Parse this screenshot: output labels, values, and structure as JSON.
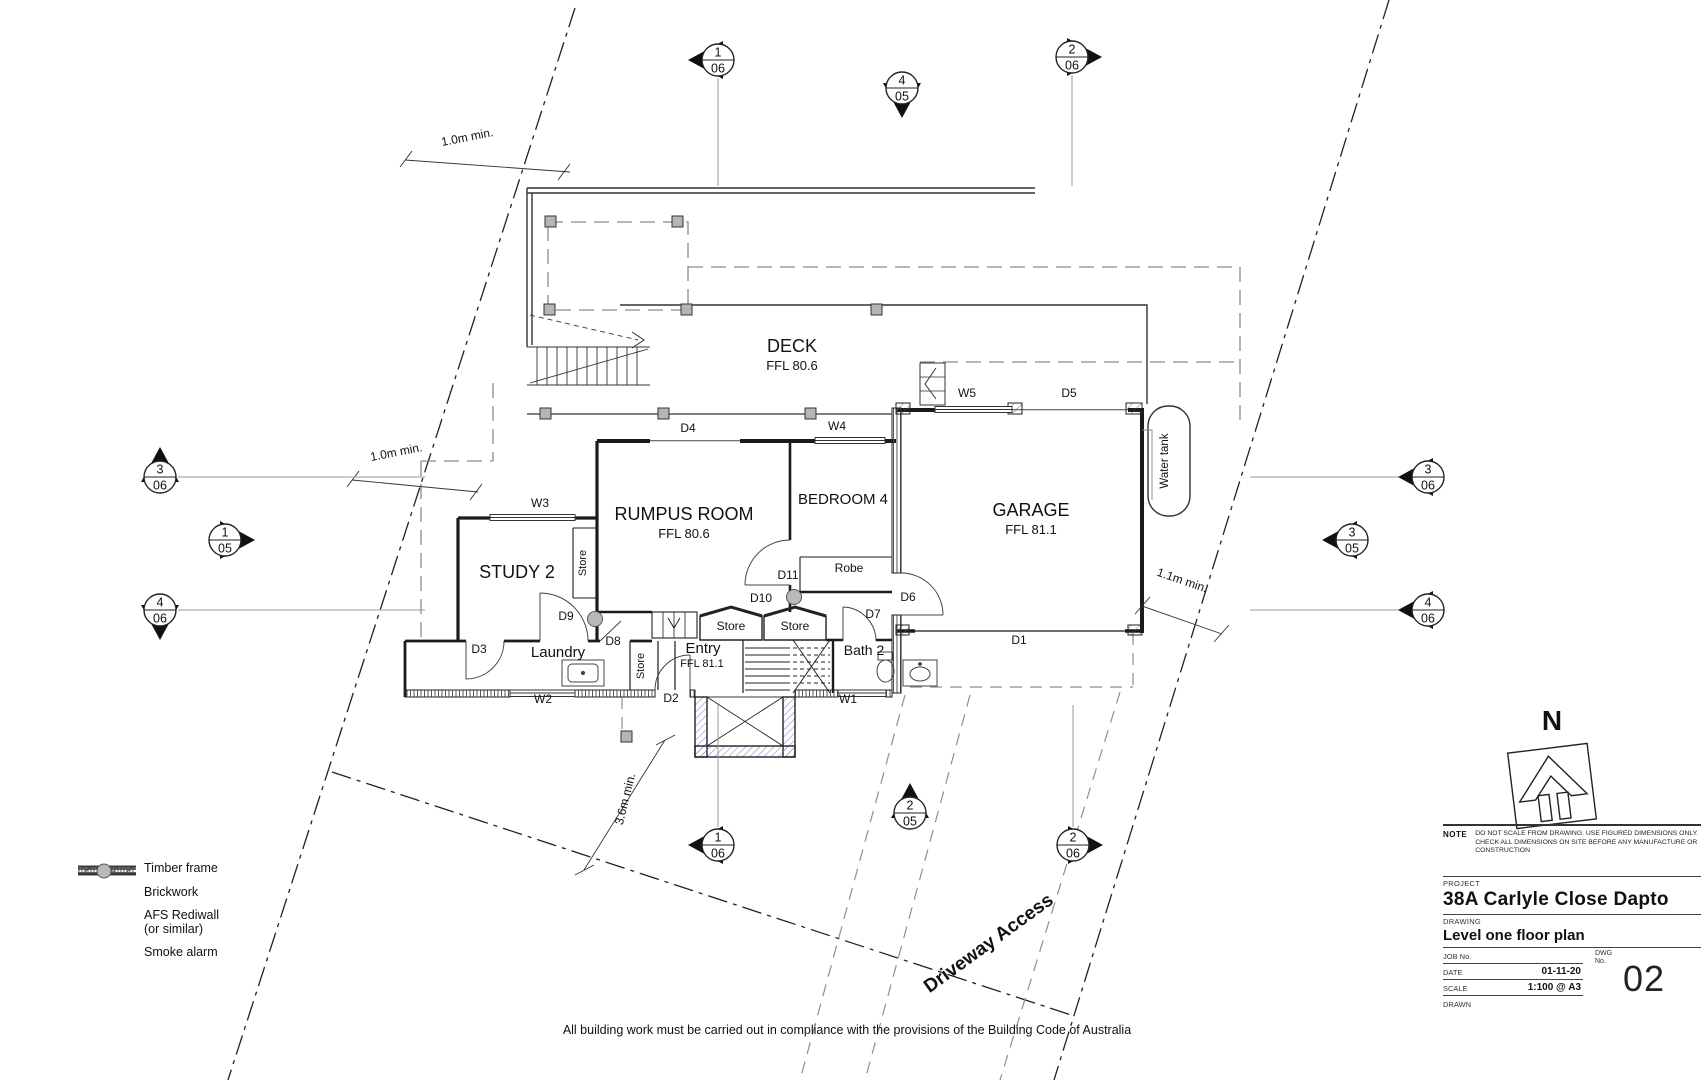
{
  "sheet": {
    "footer": "All building work must be carried out in compliance with the provisions of the Building Code of Australia"
  },
  "plan": {
    "rooms": [
      {
        "name": "DECK",
        "ffl": "FFL 80.6"
      },
      {
        "name": "RUMPUS ROOM",
        "ffl": "FFL 80.6"
      },
      {
        "name": "STUDY 2"
      },
      {
        "name": "BEDROOM 4"
      },
      {
        "name": "GARAGE",
        "ffl": "FFL 81.1"
      },
      {
        "name": "Laundry"
      },
      {
        "name": "Entry",
        "ffl": "FFL 81.1"
      },
      {
        "name": "Bath 2"
      },
      {
        "name": "Robe"
      }
    ],
    "stores": [
      "Store",
      "Store",
      "Store",
      "Store"
    ],
    "doors": [
      "D1",
      "D2",
      "D3",
      "D4",
      "D5",
      "D6",
      "D7",
      "D8",
      "D9",
      "D10",
      "D11"
    ],
    "windows": [
      "W1",
      "W2",
      "W3",
      "W4",
      "W5"
    ],
    "dimensions": [
      "1.0m min.",
      "1.0m min.",
      "1.1m min.",
      "3.6m min."
    ],
    "annotations": {
      "water_tank": "Water tank",
      "driveway": "Driveway Access",
      "north": "N"
    }
  },
  "markers": [
    {
      "num": "1",
      "sheet": "06"
    },
    {
      "num": "4",
      "sheet": "05"
    },
    {
      "num": "2",
      "sheet": "06"
    },
    {
      "num": "3",
      "sheet": "06"
    },
    {
      "num": "1",
      "sheet": "05"
    },
    {
      "num": "4",
      "sheet": "06"
    },
    {
      "num": "3",
      "sheet": "06"
    },
    {
      "num": "3",
      "sheet": "05"
    },
    {
      "num": "4",
      "sheet": "06"
    },
    {
      "num": "1",
      "sheet": "06"
    },
    {
      "num": "2",
      "sheet": "05"
    },
    {
      "num": "2",
      "sheet": "06"
    }
  ],
  "legend": {
    "items": [
      {
        "label": "Timber frame",
        "symbol": "timber-frame"
      },
      {
        "label": "Brickwork",
        "symbol": "brickwork"
      },
      {
        "label": "AFS Rediwall",
        "label2": "(or similar)",
        "symbol": "afs-rediwall"
      },
      {
        "label": "Smoke alarm",
        "symbol": "smoke-alarm"
      }
    ]
  },
  "title_block": {
    "note_label": "NOTE",
    "note_line1": "DO NOT SCALE FROM DRAWING.  USE FIGURED DIMENSIONS ONLY.",
    "note_line2": "CHECK ALL DIMENSIONS ON SITE BEFORE ANY MANUFACTURE OR CONSTRUCTION",
    "project_label": "PROJECT",
    "project": "38A Carlyle Close Dapto",
    "drawing_label": "DRAWING",
    "drawing": "Level one floor plan",
    "job_label": "JOB No.",
    "dwg_label_1": "DWG",
    "dwg_label_2": "No.",
    "date_label": "DATE",
    "date": "01-11-20",
    "scale_label": "SCALE",
    "scale": "1:100 @ A3",
    "drawn_label": "DRAWN",
    "dwg_no": "02"
  }
}
